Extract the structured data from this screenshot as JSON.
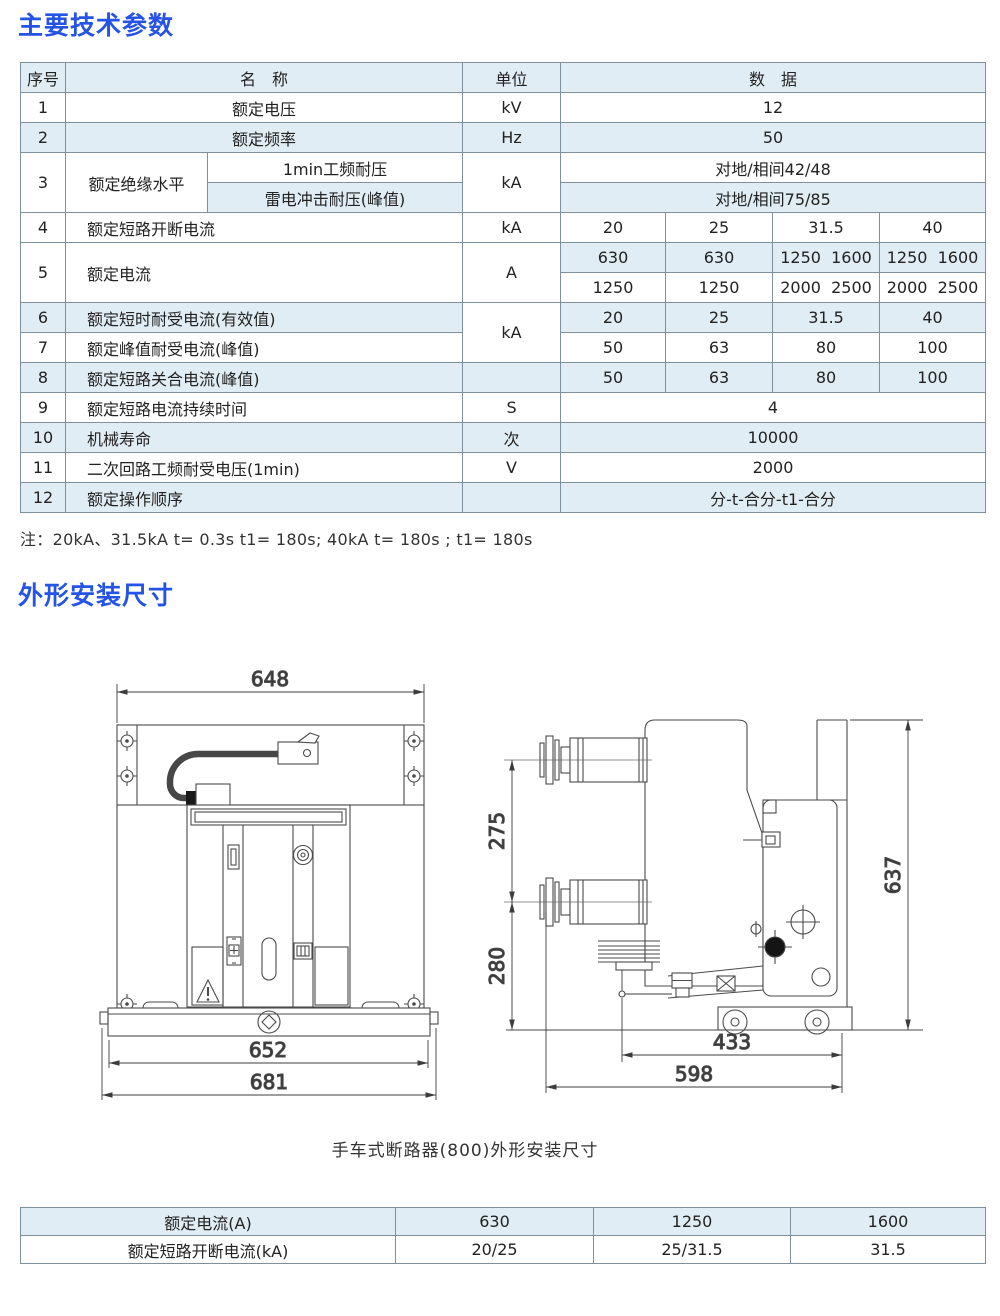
{
  "page": {
    "title1": "主要技术参数",
    "title2": "外形安装尺寸",
    "note": "注：20kA、31.5kA  t= 0.3s t1= 180s; 40kA t= 180s ; t1= 180s",
    "caption": "手车式断路器(800)外形安装尺寸",
    "colors": {
      "accent": "#2453e6",
      "row_alt": "#e1edf4",
      "border": "#7e909c"
    }
  },
  "main_table": {
    "header": {
      "no": "序号",
      "name": "名　称",
      "unit": "单位",
      "data": "数　据"
    },
    "r1": {
      "no": "1",
      "name": "额定电压",
      "unit": "kV",
      "data": "12"
    },
    "r2": {
      "no": "2",
      "name": "额定频率",
      "unit": "Hz",
      "data": "50"
    },
    "r3": {
      "no": "3",
      "name": "额定绝缘水平",
      "sub1": "1min工频耐压",
      "sub2": "雷电冲击耐压(峰值)",
      "unit": "kA",
      "data1": "对地/相间42/48",
      "data2": "对地/相间75/85"
    },
    "r4": {
      "no": "4",
      "name": "额定短路开断电流",
      "unit": "kA",
      "d1": "20",
      "d2": "25",
      "d3": "31.5",
      "d4": "40"
    },
    "r5": {
      "no": "5",
      "name": "额定电流",
      "unit": "A",
      "a1": "630",
      "a2": "630",
      "a3": "1250  1600",
      "a4": "1250  1600",
      "b1": "1250",
      "b2": "1250",
      "b3": "2000  2500",
      "b4": "2000  2500"
    },
    "r6": {
      "no": "6",
      "name": "额定短时耐受电流(有效值)",
      "unit": "kA",
      "d1": "20",
      "d2": "25",
      "d3": "31.5",
      "d4": "40"
    },
    "r7": {
      "no": "7",
      "name": "额定峰值耐受电流(峰值)",
      "d1": "50",
      "d2": "63",
      "d3": "80",
      "d4": "100"
    },
    "r8": {
      "no": "8",
      "name": "额定短路关合电流(峰值)",
      "unit": "",
      "d1": "50",
      "d2": "63",
      "d3": "80",
      "d4": "100"
    },
    "r9": {
      "no": "9",
      "name": "额定短路电流持续时间",
      "unit": "S",
      "data": "4"
    },
    "r10": {
      "no": "10",
      "name": "机械寿命",
      "unit": "次",
      "data": "10000"
    },
    "r11": {
      "no": "11",
      "name": "二次回路工频耐受电压(1min)",
      "unit": "V",
      "data": "2000"
    },
    "r12": {
      "no": "12",
      "name": "额定操作顺序",
      "unit": "",
      "data": "分-t-合分-t1-合分"
    }
  },
  "dimensions": {
    "front": {
      "top": "648",
      "base": "652",
      "overall": "681"
    },
    "side": {
      "upper": "275",
      "lower": "280",
      "height": "637",
      "inner": "433",
      "depth": "598"
    }
  },
  "bottom_table": {
    "rows": [
      {
        "label": "额定电流(A)",
        "c1": "630",
        "c2": "1250",
        "c3": "1600"
      },
      {
        "label": "额定短路开断电流(kA)",
        "c1": "20/25",
        "c2": "25/31.5",
        "c3": "31.5"
      }
    ]
  }
}
